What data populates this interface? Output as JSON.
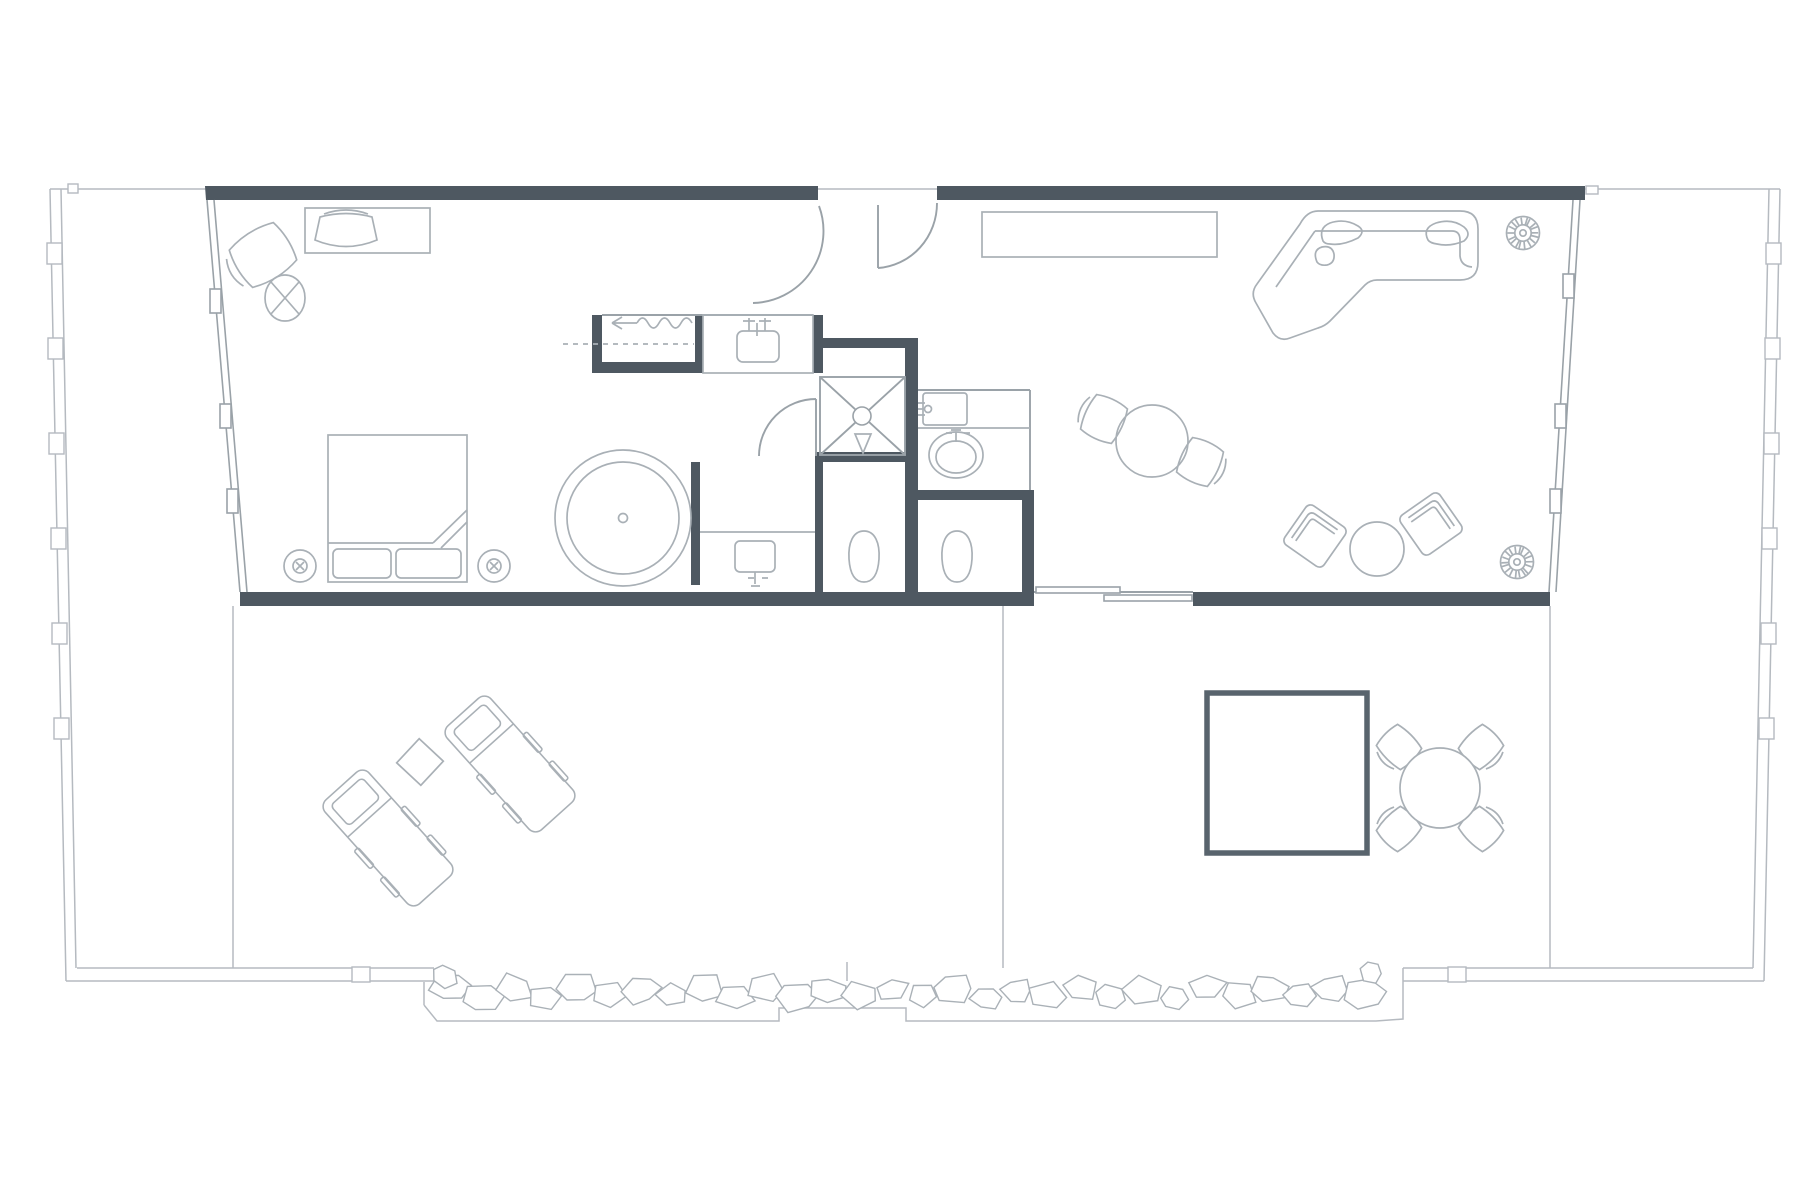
{
  "meta": {
    "kind": "architectural-floor-plan",
    "text_visible": false
  },
  "palette": {
    "bg": "#ffffff",
    "wall": "#4e5861",
    "line": "#9aa2a8",
    "furn": "#a9b0b6",
    "terr": "#b5bac0",
    "pool": "#59646d",
    "stone": "#aab1b7"
  },
  "decorations": {
    "stone_band": {
      "count": 30,
      "x_start": 437,
      "x_end": 1378,
      "y": 993,
      "seed": 11
    },
    "stone_accents": [
      {
        "cx": 444,
        "cy": 976,
        "r": 12
      },
      {
        "cx": 1371,
        "cy": 972,
        "r": 11
      }
    ],
    "plants": [
      {
        "cx": 1523,
        "cy": 233
      },
      {
        "cx": 1517,
        "cy": 562
      }
    ]
  },
  "legend": {
    "bedroom_symbols": [
      "desk",
      "desk-chair",
      "armchair",
      "round-side-table",
      "double-bed",
      "bedside-lamp",
      "bedside-lamp",
      "round-bathtub"
    ],
    "wardrobe_symbols": [
      "hanging-rail",
      "clothes-wave",
      "direction-arrow"
    ],
    "bathroom_symbols": [
      "vanity-sink-top",
      "vanity-sink-bottom",
      "oval-basin",
      "wall-cabinet",
      "walk-in-shower",
      "shower-head",
      "toilet",
      "toilet",
      "door-swing"
    ],
    "living_symbols": [
      "sideboard",
      "corner-sofa",
      "sofa-cushions",
      "potted-plant",
      "potted-plant",
      "round-dining-table",
      "dining-chair",
      "dining-chair",
      "lounge-chair",
      "lounge-chair",
      "round-coffee-table"
    ],
    "outdoor_symbols": [
      "sun-lounger",
      "sun-lounger",
      "square-side-table",
      "plunge-pool",
      "outdoor-table",
      "outdoor-chair",
      "outdoor-chair",
      "outdoor-chair",
      "outdoor-chair",
      "pebble-border",
      "deck-divider",
      "sliding-door"
    ]
  }
}
